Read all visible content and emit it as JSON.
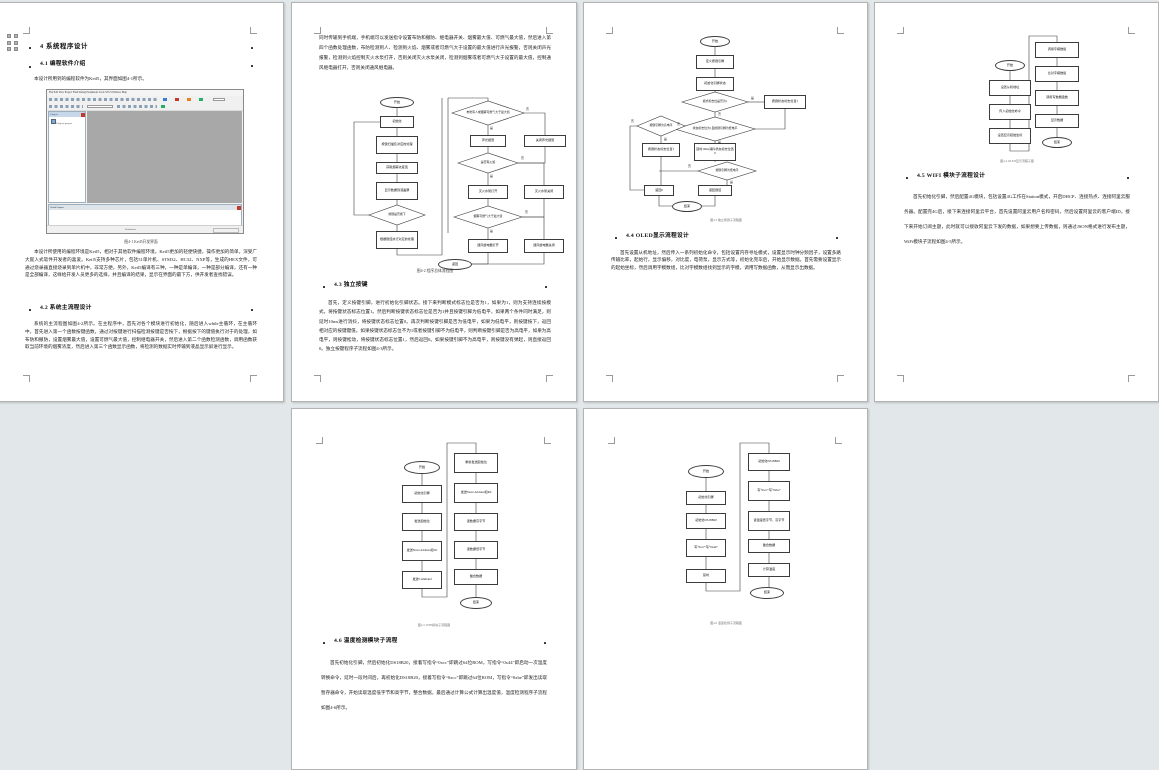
{
  "labels": {
    "yes": "是",
    "no": "否"
  },
  "pages": {
    "p1": {
      "h1": "4 系统程序设计",
      "h2": "4.1 编程软件介绍",
      "intro": "本设计所用到的编程软件为Keil5，其界面如图4-1所示。",
      "keil": {
        "menu": "File  Edit  View  Project  Flash  Debug  Peripherals  Tools  SVCS  Window  Help",
        "project_panel": "Project",
        "tree_item": "Project: project",
        "output_panel": "Build Output",
        "status": "Simulation"
      },
      "caption": "图4-1 Keil5开发界面",
      "body1": "本设计所使用的编程环境是Keil5，相对于其他软件编程环境，Keil5更加的轻便快捷，操作更加的简单，深受广大嵌入式软件开发者的喜爱。Keil5支持多种芯片，包括51单片机、STM32、HC32、NXP等，生成的HEX文件，可通过烧录器直接烧录到单片机中，非常方便。另外，Keil5编译有三种，一种是单编译，一种是部分编译，还有一种是全部编译，这样给开发人员更多的选择，并且编译的结果，显示在界面的最下方，供开发者查找错误。",
      "h3": "4.2 系统主流程设计",
      "body2": "系统的主流程图如图4-2所示。在主程序中，首先对各个模块进行初始化，随后进入while主循环，在主循环中，首先进入第一个函数按键函数，通过对按键进行扫描检测按键是否按下，根据按下的键值执行对于的处理，如布防和撤防，设置烟雾最大值，设置可燃气最大值，控制继电器开关，然后进入第二个函数检测函数，调用函数获取当前环境的烟雾浓度，然后进入第三个函数显示函数，将检测的数据实时传输到液晶显示屏进行显示。"
    },
    "p2": {
      "top": "同时传输到手机端，手机端可以发送指令设置布防和撤防、继电器开关、烟雾最大值、可燃气最大值，然后进入第四个函数处理函数，布防检测到人、检测到火焰、烟雾或者可燃气大于设置的最大值进行声光报警，否则关闭声光报警，检测到火焰控制灭火水泵打开，否则关闭灭火水泵关闭，检测到烟雾或者可燃气大于设置的最大值，控制通风继电器打开，否则关闭通风继电器。",
      "flow": {
        "start": "开始",
        "init": "初始化",
        "keyscan": "按键扫描及对应的处理",
        "smoke": "获取烟雾浓度值",
        "show": "显示数据到液晶屏",
        "keyq": "按键是否按下",
        "keydeal": "根据键值执行对应的处理",
        "alarmq": "布防有人或烟雾可燃气大于最大值",
        "alarm_on": "声光报警",
        "alarm_off": "关闭声光报警",
        "flameq": "是否有火焰",
        "pump_on": "灭火水泵打开",
        "pump_off": "灭火水泵关闭",
        "smokeq": "烟雾可燃气大于最大值",
        "fan_on": "通风继电器打开",
        "fan_off": "通风继电器关闭",
        "ret": "返回"
      },
      "caption": "图4-2 程序总体流程图",
      "h": "4.3 独立按键",
      "body": "首先，定义按键引脚，进行初始化引脚状态。接下来判断模式标志位是否为1，如果为1，则为支持连续按模式，将按键状态标志位置1。然后判断按键状态标志位是否为1并且按键引脚为低电平，如果两个条件同时满足，则延时10ms进行消抖，将按键状态标志位置0。再次判断按键引脚是否为低电平，如果为低电平，则按键按下，返回相对应的按键键值。如果按键状态标志位不为1或者按键引脚不为低电平，则判断按键引脚是否为高电平，如果为高电平，则按键松动，将按键状态标志位置1，然后返回0。如果按键引脚不为高电平，则按键没有弹起，则直接返回0。独立按键程序子流程如图4-3所示。"
    },
    "p3": {
      "flow": {
        "start": "开始",
        "def": "定义按键引脚",
        "init": "初始化引脚状态",
        "modeq": "模式标志位是否为1",
        "set1r": "按键状态标志位置1",
        "mainq": "状态标志位为1且按键引脚为低电平",
        "highq": "按键引脚为高电平",
        "set1l": "按键状态标志位置1",
        "delay": "延时10ms消抖状态标志位置0",
        "lowq": "按键引脚为低电平",
        "ret0": "返回0",
        "retv": "返回键值",
        "end": "结束"
      },
      "caption": "图4-3 独立按键子流程图",
      "h": "4.4 OLED显示流程设计",
      "body": "首先设置从机地址，然后传入一系列初始化命令，包括设置内存寻址模式，设置显示时钟分频因子，设置多路传输比率，起始行，显示偏移，对比度，电荷泵，显示方式等，初始化完毕后，开始显示数据。首先需要设置显示的起始坐标，然后调用字模数组，比对字模数组找到显示的字模，调用写数据函数，从而显示出数据。"
    },
    "p4": {
      "flow": {
        "start": "开始",
        "l1": "设置从机地址",
        "l2": "传入初始化命令",
        "l3": "设置显示起始坐标",
        "r1": "调用字模数组",
        "r2": "比对字模数组",
        "r3": "调用写数据函数",
        "r4": "显示数据",
        "end": "结束"
      },
      "caption": "图4-4 OLED显示流程子图",
      "h": "4.5 WIFI 模块子流程设计",
      "body": "首先初始化引脚，然后配置4G模块，包括设置4G工作在Station模式，开启DHCP、连接热点、连接阿里云服务器。配置完4G后，接下来连接阿里云平台，首先设置阿里云用户名和密码，然后设置阿里云的客户端ID，接下来开始订阅主题，此时就可以接收阿里云下发的数据，如果想要上传数据，则通过JSON格式进行发布主题，WiFi模块子流程如图4-5所示。"
    },
    "p5": {
      "flow": {
        "start": "开始",
        "l1": "初始化引脚",
        "l2": "发送起始位",
        "l3": "发送Slave Address和Wr",
        "l4": "发送Command",
        "r1": "重新发送起始位",
        "r2": "发送Slave Address和Rd",
        "r3": "读数据高字节",
        "r4": "读数据低字节",
        "r5": "整合数据",
        "end": "结束"
      },
      "caption": "图4-5 WIFI模块子流程图",
      "h": "4.6 温度检测模块子流程",
      "body": "首先初始化引脚，然后初始化DS18B20，接着写指令“0xcc”即跳过64位ROM，写指令“0x44”即启动一次温度转换命令，延时一段时间后，再初始化DS18B20，接着写指令“0xcc”即跳过64位ROM，写指令“0xbe”即发出读取暂存器命令，开始读取温度低字节和高字节，整合数据，最后通过计算公式计算出温度值，温度检测程序子流程如图4-6所示。"
    },
    "p6": {
      "flow": {
        "start": "开始",
        "l1": "初始化引脚",
        "l2": "初始化DS18B20",
        "l3": "写“0xcc”写“0x44”",
        "l4": "延时",
        "r1": "初始化DS18B20",
        "r2": "写“0xcc”写“0xbe”",
        "r3": "读温度低字节、高字节",
        "r4": "整合数据",
        "r5": "计算温度",
        "end": "结束"
      },
      "caption": "图4-6 温度检测子流程图"
    }
  }
}
